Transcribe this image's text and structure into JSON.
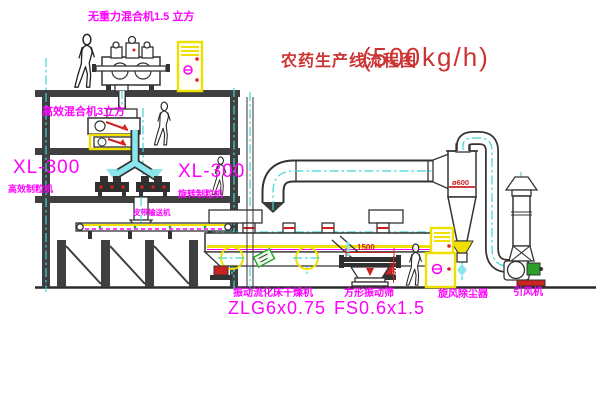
{
  "title": {
    "text": "农药生产线流程图",
    "capacity": "(500kg/h)"
  },
  "labels": {
    "top_mixer": "无重力混合机1.5 立方",
    "floor2_mixer": "高效混合机3立方",
    "granulator_left_model": "XL-300",
    "granulator_left_name": "高效制粒机",
    "granulator_mid_model": "XL-300",
    "granulator_mid_name": "旋转制粒机",
    "belt_conveyor": "皮带输送机",
    "dryer_name": "振动流化床干燥机",
    "dryer_model": "ZLG6x0.75",
    "sieve_name": "方形振动筛",
    "sieve_model": "FS0.6x1.5",
    "cyclone_name": "旋风除尘器",
    "fan_name": "引风机"
  },
  "dimensions": {
    "sieve_length": "1500",
    "sieve_height": "540",
    "cyclone_diameter": "ø600"
  },
  "colors": {
    "line": "#333333",
    "label_magenta": "#ff00ff",
    "title_red": "#cc3333",
    "dimension_red": "#cc2222",
    "highlight_yellow": "#f0e000",
    "centerline_cyan": "#3fd6d6",
    "pipe_cyan": "#8ae6ec",
    "motor_green": "#2aa02a"
  }
}
